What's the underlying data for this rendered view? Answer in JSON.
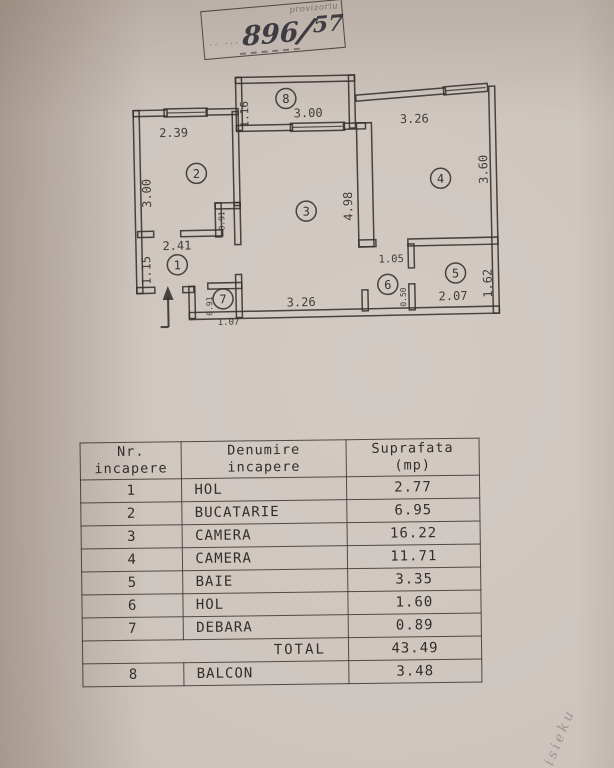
{
  "stamp": {
    "label": "provizoriu",
    "dots": "·· ···",
    "number": "896",
    "denominator": "57"
  },
  "margin_note": {
    "text": "isieku"
  },
  "plan": {
    "rooms": {
      "r1": "1",
      "r2": "2",
      "r3": "3",
      "r4": "4",
      "r5": "5",
      "r6": "6",
      "r7": "7",
      "r8": "8"
    },
    "dims": {
      "kitchen_w": "2.39",
      "kitchen_h": "3.00",
      "niche_h": "0.91",
      "balcony_d": "1.16",
      "balcony_w": "3.00",
      "room3_h": "4.98",
      "room3_w": "3.26",
      "room4_w": "3.26",
      "room4_h": "3.60",
      "hall_w": "1.05",
      "hall_s": "0.50",
      "bath_w": "2.07",
      "bath_h": "1.62",
      "hol_w": "2.41",
      "hol_h": "1.15",
      "debara_h": "0.91",
      "debara_w": "1.07"
    }
  },
  "table": {
    "headers": [
      {
        "line1": "Nr.",
        "line2": "incapere"
      },
      {
        "line1": "Denumire",
        "line2": "incapere"
      },
      {
        "line1": "Suprafata",
        "line2": "(mp)"
      }
    ],
    "rows": [
      {
        "nr": "1",
        "name": "HOL",
        "area": "2.77"
      },
      {
        "nr": "2",
        "name": "BUCATARIE",
        "area": "6.95"
      },
      {
        "nr": "3",
        "name": "CAMERA",
        "area": "16.22"
      },
      {
        "nr": "4",
        "name": "CAMERA",
        "area": "11.71"
      },
      {
        "nr": "5",
        "name": "BAIE",
        "area": "3.35"
      },
      {
        "nr": "6",
        "name": "HOL",
        "area": "1.60"
      },
      {
        "nr": "7",
        "name": "DEBARA",
        "area": "0.89"
      },
      {
        "is_total": true,
        "total_label": "TOTAL",
        "area": "43.49"
      },
      {
        "nr": "8",
        "name": "BALCON",
        "area": "3.48"
      }
    ]
  }
}
